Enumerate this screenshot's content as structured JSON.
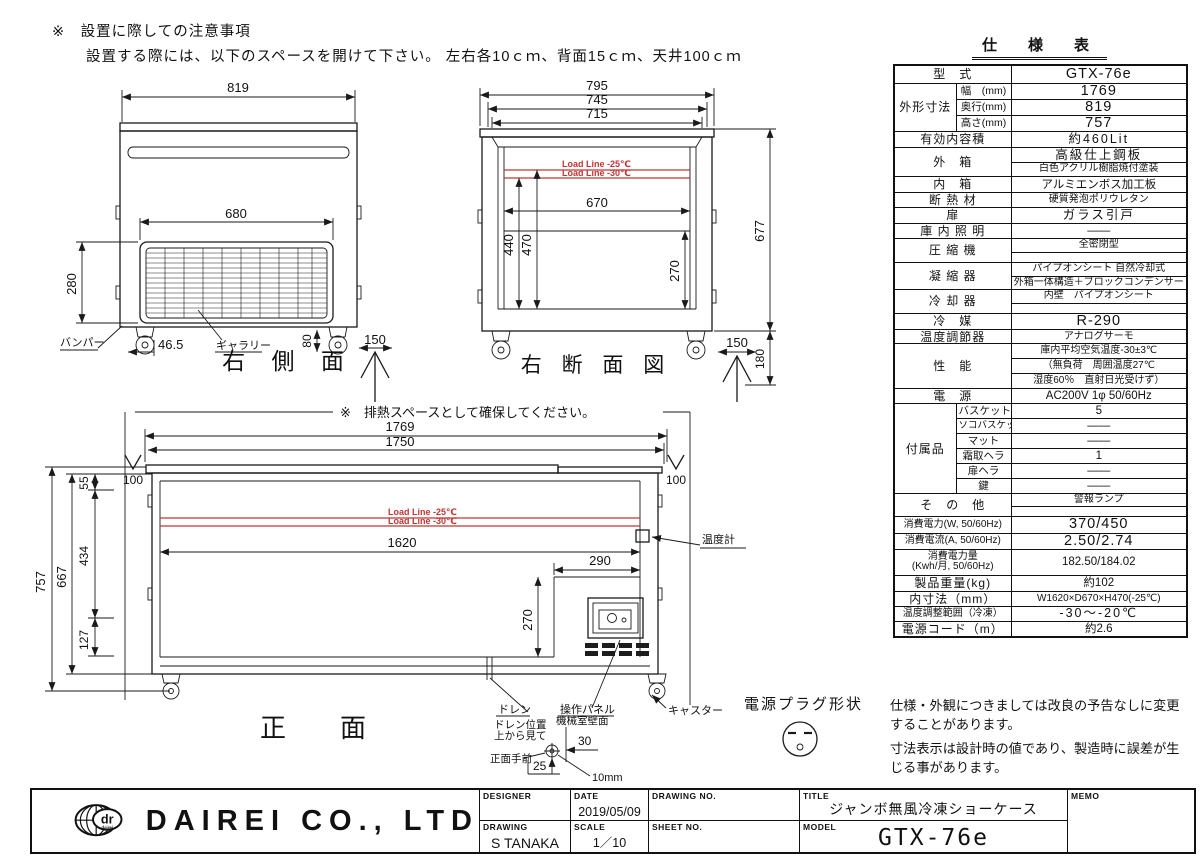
{
  "notes": {
    "install_title": "※　設置に際しての注意事項",
    "install_body": "設置する際には、以下のスペースを開けて下さい。 左右各10ｃｍ、背面15ｃｍ、天井100ｃｍ",
    "heat_space": "※　排熱スペースとして確保してください。",
    "disclaimer_line1": "仕様・外観につきましては改良の予告なしに変更することがあります。",
    "disclaimer_line2": "寸法表示は設計時の値であり、製造時に誤差が生じる事があります。"
  },
  "side_view": {
    "title": "右 側 面",
    "dim_width": "819",
    "dim_grille_w": "680",
    "dim_grille_h": "280",
    "dim_bumper": "46.5",
    "dim_caster_h": "80",
    "dim_space": "150",
    "label_bumper": "バンパー",
    "label_gallery": "ギャラリー"
  },
  "section_view": {
    "title": "右 断 面 図",
    "dim_w1": "795",
    "dim_w2": "745",
    "dim_w3": "715",
    "dim_inner_w": "670",
    "dim_h_470": "470",
    "dim_h_440": "440",
    "dim_h_270": "270",
    "dim_total_h": "677",
    "dim_bottom": "180",
    "dim_space": "150",
    "load_line_25": "Load Line -25℃",
    "load_line_30": "Load Line -30℃"
  },
  "front_view": {
    "title": "正　面",
    "dim_w1": "1769",
    "dim_w2": "1750",
    "dim_side_left": "100",
    "dim_side_right": "100",
    "dim_h55": "55",
    "dim_h434": "434",
    "dim_h127": "127",
    "dim_h667": "667",
    "dim_h757": "757",
    "dim_inner_w": "1620",
    "dim_mr_w": "290",
    "dim_mr_h": "270",
    "load_line_25": "Load Line -25℃",
    "load_line_30": "Load Line -30℃",
    "label_thermometer": "温度計",
    "label_drain": "ドレン",
    "label_panel": "操作パネル",
    "label_caster": "キャスター"
  },
  "drain_detail": {
    "line1": "ドレン位置",
    "line2": "上から見て",
    "wall": "機械室壁面",
    "front": "正面手前",
    "dim_30": "30",
    "dim_25": "25",
    "dim_10": "10mm"
  },
  "plug": {
    "label": "電源プラグ形状"
  },
  "spec": {
    "title": "仕　様　表",
    "rows": [
      {
        "h": 18,
        "cells": [
          {
            "t": "型　式",
            "c": 2,
            "k": "l"
          },
          {
            "t": "GTX-76e",
            "k": "vb"
          }
        ]
      },
      {
        "h": 16,
        "cells": [
          {
            "t": "外形寸法",
            "r": 3,
            "k": "l"
          },
          {
            "t": "幅　(mm)",
            "k": "s"
          },
          {
            "t": "1769",
            "k": "vb"
          }
        ]
      },
      {
        "h": 16,
        "cells": [
          {
            "t": "奥行(mm)",
            "k": "s"
          },
          {
            "t": "819",
            "k": "vb"
          }
        ]
      },
      {
        "h": 16,
        "cells": [
          {
            "t": "高さ(mm)",
            "k": "s"
          },
          {
            "t": "757",
            "k": "vb"
          }
        ]
      },
      {
        "h": 16,
        "cells": [
          {
            "t": "有効内容積",
            "c": 2,
            "k": "l"
          },
          {
            "t": "約460Lit",
            "k": "vw"
          }
        ]
      },
      {
        "h": 15,
        "cells": [
          {
            "t": "外　箱",
            "c": 2,
            "r": 2,
            "k": "l"
          },
          {
            "t": "高級仕上鋼板",
            "k": "vw"
          }
        ]
      },
      {
        "h": 14,
        "cells": [
          {
            "t": "白色アクリル樹脂焼付塗装",
            "k": "vs"
          }
        ]
      },
      {
        "h": 16,
        "cells": [
          {
            "t": "内　箱",
            "c": 2,
            "k": "l"
          },
          {
            "t": "アルミエンボス加工板",
            "k": "v"
          }
        ]
      },
      {
        "h": 15,
        "cells": [
          {
            "t": "断 熱 材",
            "c": 2,
            "k": "l"
          },
          {
            "t": "硬質発泡ポリウレタン",
            "k": "vs"
          }
        ]
      },
      {
        "h": 16,
        "cells": [
          {
            "t": "扉",
            "c": 2,
            "k": "l"
          },
          {
            "t": "ガラス引戸",
            "k": "vw"
          }
        ]
      },
      {
        "h": 15,
        "cells": [
          {
            "t": "庫 内 照 明",
            "c": 2,
            "k": "l"
          },
          {
            "t": "——",
            "k": "v"
          }
        ]
      },
      {
        "h": 14,
        "cells": [
          {
            "t": "圧 縮 機",
            "c": 2,
            "r": 2,
            "k": "l"
          },
          {
            "t": "全密閉型",
            "k": "vs"
          }
        ]
      },
      {
        "h": 10,
        "cells": [
          {
            "t": "",
            "k": "v"
          }
        ]
      },
      {
        "h": 14,
        "cells": [
          {
            "t": "凝 縮 器",
            "c": 2,
            "r": 2,
            "k": "l"
          },
          {
            "t": "パイプオンシート 自然冷却式",
            "k": "vs"
          }
        ]
      },
      {
        "h": 13,
        "cells": [
          {
            "t": "外箱一体構造＋ブロックコンデンサー",
            "k": "vs"
          }
        ]
      },
      {
        "h": 14,
        "cells": [
          {
            "t": "冷 却 器",
            "c": 2,
            "r": 2,
            "k": "l"
          },
          {
            "t": "内壁　パイプオンシート",
            "k": "vs"
          }
        ]
      },
      {
        "h": 10,
        "cells": [
          {
            "t": "",
            "k": "v"
          }
        ]
      },
      {
        "h": 16,
        "cells": [
          {
            "t": "冷　媒",
            "c": 2,
            "k": "l"
          },
          {
            "t": "R-290",
            "k": "vb"
          }
        ]
      },
      {
        "h": 14,
        "cells": [
          {
            "t": "温度調節器",
            "c": 2,
            "k": "l"
          },
          {
            "t": "アナログサーモ",
            "k": "vs"
          }
        ]
      },
      {
        "h": 15,
        "cells": [
          {
            "t": "性　能",
            "c": 2,
            "r": 3,
            "k": "l"
          },
          {
            "t": "庫内平均空気温度-30±3℃",
            "k": "vs"
          }
        ]
      },
      {
        "h": 15,
        "cells": [
          {
            "t": "（無負荷　周囲温度27℃",
            "k": "vsl"
          }
        ]
      },
      {
        "h": 15,
        "cells": [
          {
            "t": "湿度60％　直射日光受けず）",
            "k": "vs"
          }
        ]
      },
      {
        "h": 15,
        "cells": [
          {
            "t": "電　源",
            "c": 2,
            "k": "l"
          },
          {
            "t": "AC200V 1φ 50/60Hz",
            "k": "v"
          }
        ]
      },
      {
        "h": 15,
        "cells": [
          {
            "t": "付属品",
            "r": 6,
            "k": "l"
          },
          {
            "t": "バスケット",
            "k": "s"
          },
          {
            "t": "5",
            "k": "v"
          }
        ]
      },
      {
        "h": 15,
        "cells": [
          {
            "t": "ソコバスケット",
            "k": "ss"
          },
          {
            "t": "——",
            "k": "v"
          }
        ]
      },
      {
        "h": 15,
        "cells": [
          {
            "t": "マット",
            "k": "s"
          },
          {
            "t": "——",
            "k": "v"
          }
        ]
      },
      {
        "h": 15,
        "cells": [
          {
            "t": "霜取ヘラ",
            "k": "s"
          },
          {
            "t": "1",
            "k": "v"
          }
        ]
      },
      {
        "h": 15,
        "cells": [
          {
            "t": "扉ヘラ",
            "k": "s"
          },
          {
            "t": "——",
            "k": "v"
          }
        ]
      },
      {
        "h": 15,
        "cells": [
          {
            "t": "鍵",
            "k": "s"
          },
          {
            "t": "——",
            "k": "v"
          }
        ]
      },
      {
        "h": 13,
        "cells": [
          {
            "t": "そ　の　他",
            "c": 2,
            "r": 2,
            "k": "l"
          },
          {
            "t": "警報ランプ",
            "k": "vs"
          }
        ]
      },
      {
        "h": 10,
        "cells": [
          {
            "t": "",
            "k": "v"
          }
        ]
      },
      {
        "h": 15,
        "cells": [
          {
            "t": "消費電力(W, 50/60Hz)",
            "c": 2,
            "k": "ls"
          },
          {
            "t": "370/450",
            "k": "vb"
          }
        ]
      },
      {
        "h": 15,
        "cells": [
          {
            "t": "消費電流(A, 50/60Hz)",
            "c": 2,
            "k": "ls"
          },
          {
            "t": "2.50/2.74",
            "k": "vb"
          }
        ]
      },
      {
        "h": 26,
        "cells": [
          {
            "t": "消費電力量\n(Kwh/月, 50/60Hz)",
            "c": 2,
            "k": "ls"
          },
          {
            "t": "182.50/184.02",
            "k": "v"
          }
        ]
      },
      {
        "h": 16,
        "cells": [
          {
            "t": "製品重量(kg)",
            "c": 2,
            "k": "l"
          },
          {
            "t": "約102",
            "k": "v"
          }
        ]
      },
      {
        "h": 15,
        "cells": [
          {
            "t": "内寸法（mm）",
            "c": 2,
            "k": "l"
          },
          {
            "t": "W1620×D670×H470(-25℃)",
            "k": "vs"
          }
        ]
      },
      {
        "h": 15,
        "cells": [
          {
            "t": "温度調整範囲（冷凍）",
            "c": 2,
            "k": "ls"
          },
          {
            "t": "-30～-20℃",
            "k": "vw"
          }
        ]
      },
      {
        "h": 16,
        "cells": [
          {
            "t": "電源コード（m）",
            "c": 2,
            "k": "l"
          },
          {
            "t": "約2.6",
            "k": "v"
          }
        ]
      }
    ]
  },
  "title_block": {
    "company": "DAIREI CO., LTD",
    "logo_dr": "dr",
    "logo_sub": "dairei",
    "designer_label": "DESIGNER",
    "date_label": "DATE",
    "drawing_no_label": "DRAWING NO.",
    "title_label": "TITLE",
    "memo_label": "MEMO",
    "drawing_label": "DRAWING",
    "scale_label": "SCALE",
    "sheet_no_label": "SHEET NO.",
    "model_label": "MODEL",
    "date_value": "2019/05/09",
    "drawing_value": "S TANAKA",
    "scale_value": "1／10",
    "title_value": "ジャンボ無風冷凍ショーケース",
    "model_value": "GTX-76e"
  }
}
